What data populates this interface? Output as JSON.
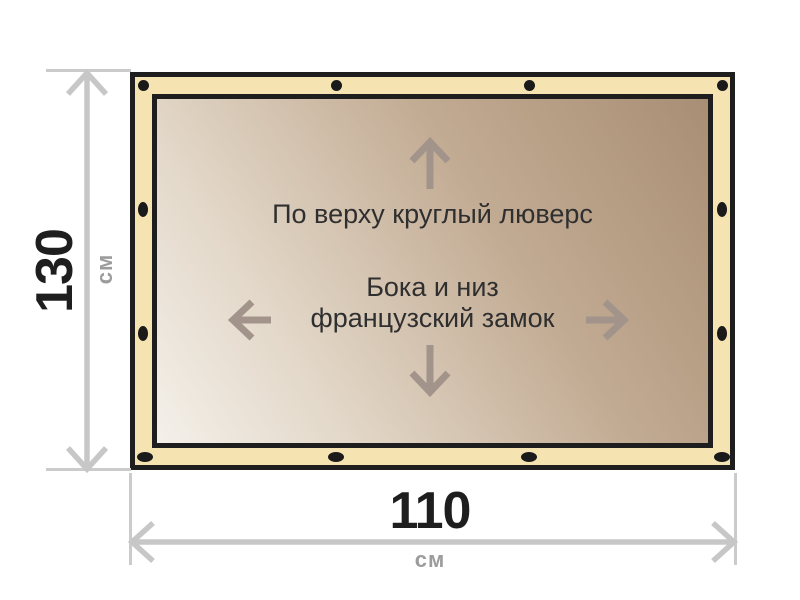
{
  "banner": {
    "annotations": {
      "top": "По верху круглый люверс",
      "middle_line1": "Бока и низ",
      "middle_line2": "французский замок"
    },
    "colors": {
      "edge_band": "#f6e3b2",
      "border": "#1e1e1e",
      "grommet": "#1a1a1a",
      "surface_gradient": [
        "#f4f0ea",
        "#e3d8c9",
        "#c2ab93",
        "#a88e74"
      ],
      "annotation_text": "#2f2f2f",
      "annotation_arrow": "#a2948a"
    }
  },
  "dimensions": {
    "height": {
      "value": "130",
      "unit": "см"
    },
    "width": {
      "value": "110",
      "unit": "см"
    },
    "colors": {
      "value_text": "#1e1e1e",
      "unit_text": "#9c9c9c",
      "line": "#c7c7c7",
      "extension_line": "#cbcbcb"
    }
  }
}
